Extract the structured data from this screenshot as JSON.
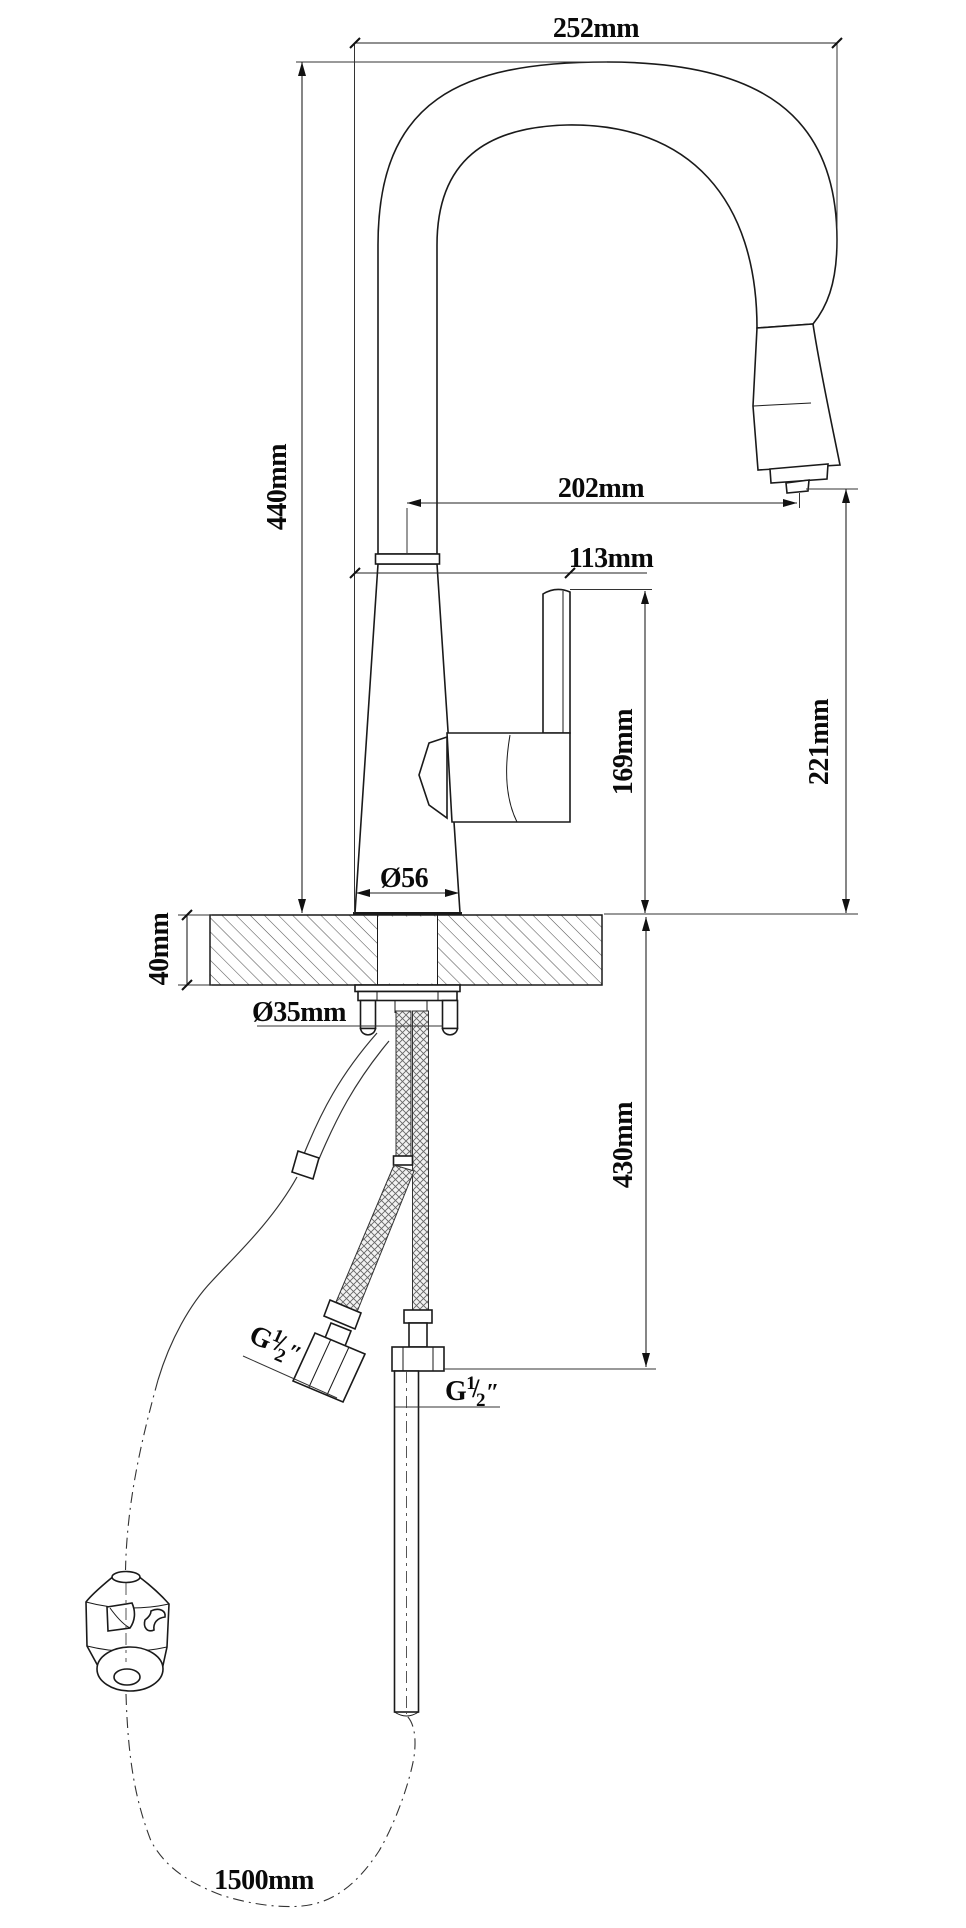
{
  "page": {
    "kind": "technical installation drawing",
    "subject": "pull-down kitchen faucet with dimensions",
    "units": "mm",
    "background": "#ffffff",
    "line_color": "#1a1a1a"
  },
  "labels": {
    "spout_top_width": "252mm",
    "overall_height": "440mm",
    "outlet_reach": "202mm",
    "handle_reach": "113mm",
    "outlet_height_above_deck": "221mm",
    "handle_height_above_deck": "169mm",
    "base_diameter": "Ø56",
    "countertop_thickness": "40mm",
    "mounting_hole_diameter": "Ø35mm",
    "under_counter_drop": "430mm",
    "hose_length": "1500mm"
  },
  "values": {
    "spout_top_width_mm": 252,
    "overall_height_mm": 440,
    "outlet_reach_mm": 202,
    "handle_reach_mm": 113,
    "outlet_height_mm": 221,
    "handle_height_mm": 169,
    "base_diameter_mm": 56,
    "countertop_thickness_mm": 40,
    "mounting_hole_diameter_mm": 35,
    "under_counter_drop_mm": 430,
    "hose_length_mm": 1500
  },
  "thread_label": {
    "prefix": "G",
    "numerator": "1",
    "slash": "/",
    "denominator": "2",
    "inch_mark": "″"
  }
}
